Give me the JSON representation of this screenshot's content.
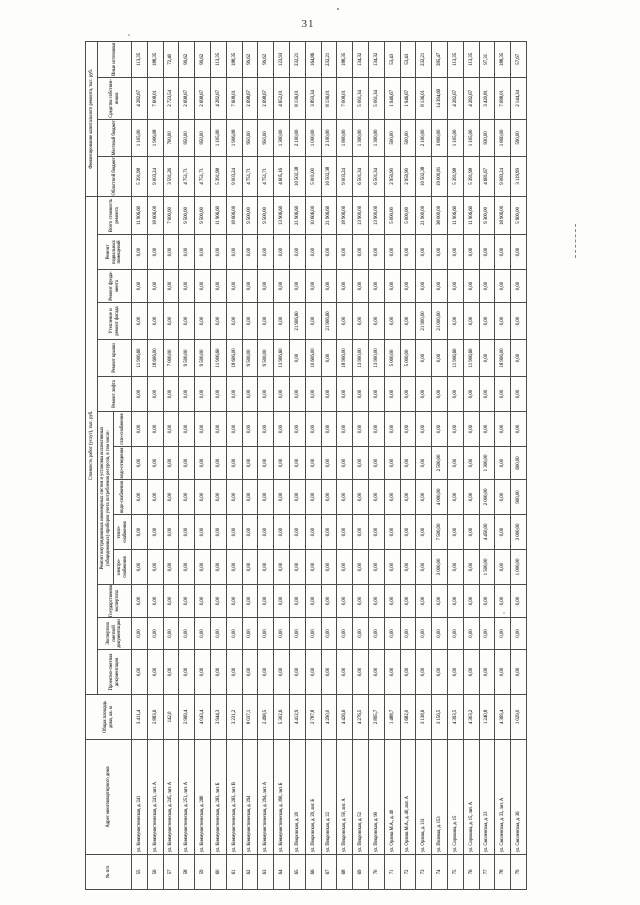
{
  "page": {
    "number": "31"
  },
  "table": {
    "headers": {
      "num": "№ п/п",
      "address": "Адрес многоквартирного дома",
      "area": "Общая площадь дома, кв. м",
      "cost_group": "Стоимость работ (услуг), тыс. руб.",
      "finance_group": "Финансирование капитального ремонта, тыс. руб.",
      "psd": "Проектно-сметная документация",
      "expertise": "Экспертиза сметной документации",
      "state_expertise": "Государственная экспертиза",
      "systems_group": "Ремонт внутридомовых инженерных систем и установка коллективных (общедомовых) приборов учета потребления ресурсов, в том числе:",
      "electricity": "электро-снабжения",
      "heating": "тепло-снабжения",
      "water": "водо-снабжения",
      "sewerage": "водо-отведения",
      "gas": "газо-снабжения",
      "elevator": "Ремонт лифта",
      "roof": "Ремонт крыши",
      "facade": "Утепление и ремонт фасада",
      "foundation": "Ремонт фунда- мента",
      "basement": "Ремонт подвальных помещений",
      "total": "Всего стоимость ремонта",
      "regional_budget": "Областной бюджет",
      "local_budget": "Местный бюджет",
      "owners_funds": "Средства собствен- ников",
      "other_sources": "Иные источники"
    },
    "rows": [
      [
        "55",
        "ул. Коммунистическая, д. 241",
        "3 411,4",
        "0,00",
        "0,00",
        "0,00",
        "0,00",
        "0,00",
        "0,00",
        "0,00",
        "0,00",
        "0,00",
        "11 906,60",
        "0,00",
        "0,00",
        "0,00",
        "11 906,60",
        "5 391,98",
        "1 105,00",
        "4 282,67",
        "113,35"
      ],
      [
        "56",
        "ул. Коммунистическая, д. 241, лит. А",
        "2 883,6",
        "0,00",
        "0,00",
        "0,00",
        "0,00",
        "0,00",
        "0,00",
        "0,00",
        "0,00",
        "0,00",
        "18 606,00",
        "0,00",
        "0,00",
        "0,00",
        "18 606,00",
        "9 003,24",
        "1 906,08",
        "7 608,01",
        "188,35"
      ],
      [
        "57",
        "ул. Коммунистическая, д. 245, лит. А",
        "142,0",
        "0,00",
        "0,00",
        "0,00",
        "0,00",
        "0,00",
        "0,00",
        "0,00",
        "0,00",
        "0,00",
        "7 000,00",
        "0,00",
        "0,00",
        "0,00",
        "7 000,00",
        "3 591,26",
        "700,00",
        "2 723,54",
        "72,40"
      ],
      [
        "58",
        "ул. Коммунистическая, д. 251, лит. А",
        "2 969,4",
        "0,00",
        "0,00",
        "0,00",
        "0,00",
        "0,00",
        "0,00",
        "0,00",
        "0,00",
        "0,00",
        "9 500,00",
        "0,00",
        "0,00",
        "0,00",
        "9 500,00",
        "4 751,71",
        "950,00",
        "2 698,67",
        "99,62"
      ],
      [
        "59",
        "ул. Коммунистическая, д. 280",
        "4 043,4",
        "0,00",
        "0,00",
        "0,00",
        "0,00",
        "0,00",
        "0,00",
        "0,00",
        "0,00",
        "0,00",
        "9 500,00",
        "0,00",
        "0,00",
        "0,00",
        "9 500,00",
        "4 751,71",
        "950,00",
        "2 698,67",
        "99,62"
      ],
      [
        "60",
        "ул. Коммунистическая, д. 283, лит. Б",
        "3 944,3",
        "0,00",
        "0,00",
        "0,00",
        "0,00",
        "0,00",
        "0,00",
        "0,00",
        "0,00",
        "0,00",
        "11 906,60",
        "0,00",
        "0,00",
        "0,00",
        "11 906,60",
        "5 391,98",
        "1 105,00",
        "4 282,67",
        "113,35"
      ],
      [
        "61",
        "ул. Коммунистическая, д. 283, лит. В",
        "3 231,2",
        "0,00",
        "0,00",
        "0,00",
        "0,00",
        "0,00",
        "0,00",
        "0,00",
        "0,00",
        "0,00",
        "18 606,00",
        "0,00",
        "0,00",
        "0,00",
        "18 606,00",
        "9 003,24",
        "1 906,08",
        "7 608,01",
        "188,35"
      ],
      [
        "62",
        "ул. Коммунистическая, д. 294",
        "8 037,1",
        "0,00",
        "0,00",
        "0,00",
        "0,00",
        "0,00",
        "0,00",
        "0,00",
        "0,00",
        "0,00",
        "9 500,00",
        "0,00",
        "0,00",
        "0,00",
        "9 500,00",
        "4 751,71",
        "950,00",
        "2 698,67",
        "99,62"
      ],
      [
        "63",
        "ул. Коммунистическая, д. 294, лит. А",
        "2 498,5",
        "0,00",
        "0,00",
        "0,00",
        "0,00",
        "0,00",
        "0,00",
        "0,00",
        "0,00",
        "0,00",
        "9 500,00",
        "0,00",
        "0,00",
        "0,00",
        "9 500,00",
        "4 751,71",
        "950,00",
        "2 698,67",
        "99,62"
      ],
      [
        "64",
        "ул. Коммунистическая, д. 390, лит. Б",
        "5 302,6",
        "0,00",
        "0,00",
        "0,00",
        "0,00",
        "0,00",
        "0,00",
        "0,00",
        "0,00",
        "0,00",
        "13 906,60",
        "0,00",
        "0,00",
        "0,00",
        "13 906,60",
        "4 605,16",
        "1 300,00",
        "4 652,01",
        "123,93"
      ],
      [
        "65",
        "ул. Покровская, д. 20",
        "4 412,9",
        "0,00",
        "0,00",
        "0,00",
        "0,00",
        "0,00",
        "0,00",
        "0,00",
        "0,00",
        "0,00",
        "0,00",
        "21 906,60",
        "0,00",
        "0,00",
        "21 906,60",
        "10 502,38",
        "2 100,00",
        "8 136,01",
        "232,21"
      ],
      [
        "66",
        "ул. Покровская, д. 20, лит. Б",
        "2 787,8",
        "0,00",
        "0,00",
        "0,00",
        "0,00",
        "0,00",
        "0,00",
        "0,00",
        "0,00",
        "0,00",
        "10 606,00",
        "0,00",
        "0,00",
        "0,00",
        "10 606,00",
        "5 001,00",
        "1 000,00",
        "3 893,34",
        "164,86"
      ],
      [
        "67",
        "ул. Покровская, д. 22",
        "4 290,0",
        "0,00",
        "0,00",
        "0,00",
        "0,00",
        "0,00",
        "0,00",
        "0,00",
        "0,00",
        "0,00",
        "0,00",
        "21 906,60",
        "0,00",
        "0,00",
        "21 906,60",
        "10 502,38",
        "2 100,00",
        "8 136,01",
        "232,21"
      ],
      [
        "68",
        "ул. Покровская, д. 50, лит. А",
        "4 426,6",
        "0,00",
        "0,00",
        "0,00",
        "0,00",
        "0,00",
        "0,00",
        "0,00",
        "0,00",
        "0,00",
        "18 906,00",
        "0,00",
        "0,00",
        "0,00",
        "18 906,00",
        "9 003,24",
        "1 800,00",
        "7 008,01",
        "188,35"
      ],
      [
        "69",
        "ул. Покровская, д. 52",
        "4 276,5",
        "0,00",
        "0,00",
        "0,00",
        "0,00",
        "0,00",
        "0,00",
        "0,00",
        "0,00",
        "0,00",
        "13 900,00",
        "0,00",
        "0,00",
        "0,00",
        "13 900,00",
        "6 501,34",
        "1 300,00",
        "5 061,34",
        "134,32"
      ],
      [
        "70",
        "ул. Покровская, д. 90",
        "2 895,7",
        "0,00",
        "0,00",
        "0,00",
        "0,00",
        "0,00",
        "0,00",
        "0,00",
        "0,00",
        "0,00",
        "13 900,00",
        "0,00",
        "0,00",
        "0,00",
        "13 900,00",
        "6 501,34",
        "1 300,00",
        "5 061,34",
        "134,32"
      ],
      [
        "71",
        "ул. Орлова М.А., д. 40",
        "1 488,7",
        "0,00",
        "0,00",
        "0,00",
        "0,00",
        "0,00",
        "0,00",
        "0,00",
        "0,00",
        "0,00",
        "5 000,00",
        "0,00",
        "0,00",
        "0,00",
        "5 000,00",
        "2 950,90",
        "500,00",
        "1 946,67",
        "53,43"
      ],
      [
        "72",
        "ул. Орлова М.А., д. 40, лит. А",
        "1 682,0",
        "0,00",
        "0,00",
        "0,00",
        "0,00",
        "0,00",
        "0,00",
        "0,00",
        "0,00",
        "0,00",
        "5 000,00",
        "0,00",
        "0,00",
        "0,00",
        "5 000,00",
        "2 950,90",
        "500,00",
        "1 946,67",
        "53,43"
      ],
      [
        "73",
        "ул. Орлова, д. 131",
        "3 138,6",
        "0,00",
        "0,00",
        "0,00",
        "0,00",
        "0,00",
        "0,00",
        "0,00",
        "0,00",
        "0,00",
        "0,00",
        "21 900,00",
        "0,00",
        "0,00",
        "21 900,00",
        "10 502,38",
        "2 100,00",
        "8 136,01",
        "232,21"
      ],
      [
        "74",
        "ул. Полевая, д. 153",
        "3 156,5",
        "0,00",
        "0,00",
        "0,00",
        "3 000,00",
        "7 500,00",
        "4 000,00",
        "2 500,00",
        "0,00",
        "0,00",
        "0,00",
        "21 000,00",
        "0,00",
        "0,00",
        "38 000,00",
        "19 000,81",
        "3 800,00",
        "14 394,69",
        "395,47"
      ],
      [
        "75",
        "ул. Сорокина, д. 15",
        "4 393,5",
        "0,00",
        "0,00",
        "0,00",
        "0,00",
        "0,00",
        "0,00",
        "0,00",
        "0,00",
        "0,00",
        "11 906,60",
        "0,00",
        "0,00",
        "0,00",
        "11 906,60",
        "5 391,98",
        "1 105,00",
        "4 282,67",
        "113,35"
      ],
      [
        "76",
        "ул. Сорокина, д. 15, лит. А",
        "4 303,2",
        "0,00",
        "0,00",
        "0,00",
        "0,00",
        "0,00",
        "0,00",
        "0,00",
        "0,00",
        "0,00",
        "11 906,60",
        "0,00",
        "0,00",
        "0,00",
        "11 906,60",
        "5 391,98",
        "1 105,00",
        "4 282,67",
        "113,35"
      ],
      [
        "77",
        "ул. Смоленская, д. 23",
        "1 240,8",
        "0,00",
        "0,00",
        "0,00",
        "1 500,00",
        "4 450,00",
        "2 000,00",
        "1 300,00",
        "0,00",
        "0,00",
        "0,00",
        "0,00",
        "0,00",
        "0,00",
        "9 300,00",
        "4 681,67",
        "930,00",
        "3 420,81",
        "97,31"
      ],
      [
        "78",
        "ул. Смоленская, д. 32, лит. А",
        "4 369,4",
        "0,00",
        "0,00",
        "0,00",
        "0,00",
        "0,00",
        "0,00",
        "0,00",
        "0,00",
        "0,00",
        "18 906,00",
        "0,00",
        "0,00",
        "0,00",
        "18 906,00",
        "9 083,24",
        "1 800,00",
        "7 088,01",
        "188,35"
      ],
      [
        "79",
        "ул. Смоленская, д. 36",
        "1 029,0",
        "0,00",
        "0,00",
        "0,00",
        "1 000,00",
        "3 000,00",
        "900,00",
        "600,00",
        "0,00",
        "0,00",
        "0,00",
        "0,00",
        "0,00",
        "0,00",
        "5 900,00",
        "3 119,99",
        "590,00",
        "2 144,34",
        "57,67"
      ]
    ]
  }
}
